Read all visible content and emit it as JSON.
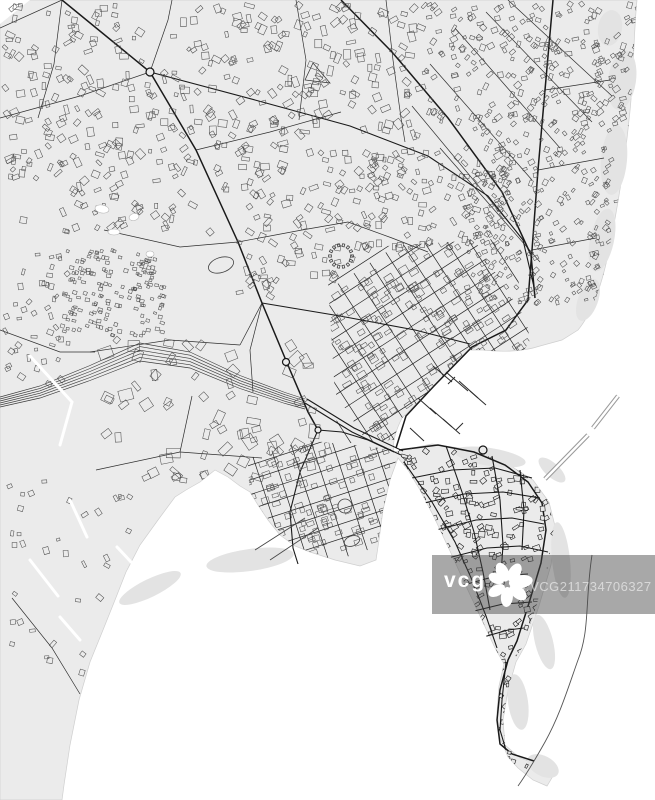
{
  "watermark": {
    "brand": "vcg",
    "logo_icon": "vcg-flower-logo-icon",
    "image_id": "ID:VCG211734706327"
  },
  "colors": {
    "land": "#ebebeb",
    "water": "#ffffff",
    "roads": "#1a1a1a",
    "buildings_outline": "#4f4f4f",
    "watermark_band": "rgba(70,70,70,0.47)",
    "watermark_text": "#ffffff"
  }
}
